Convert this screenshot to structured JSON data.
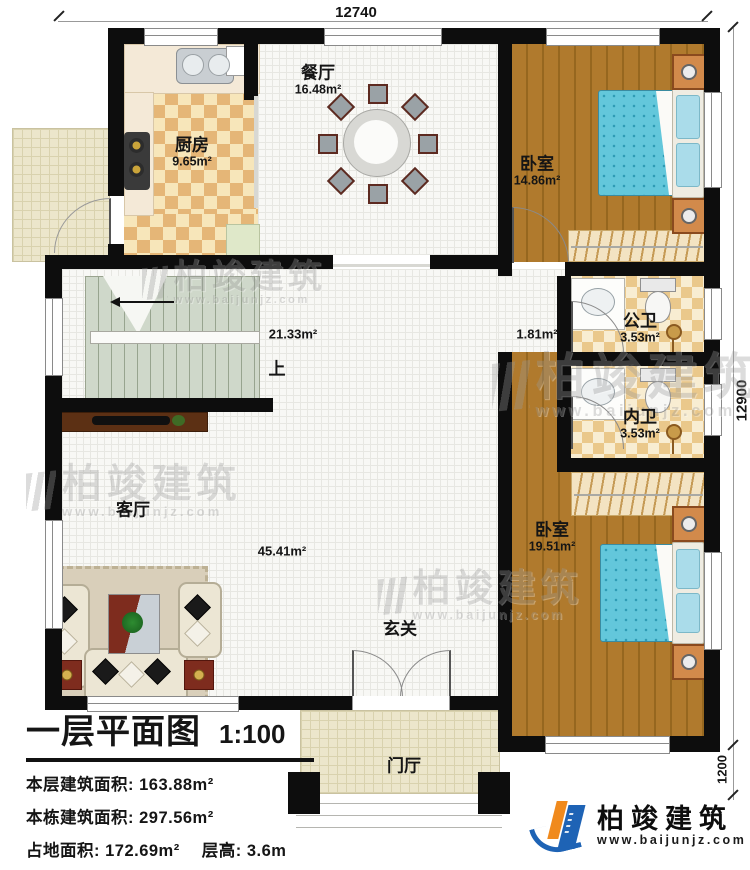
{
  "dimensions": {
    "top": "12740",
    "right": "12900",
    "porch": "1200"
  },
  "rooms": {
    "kitchen": {
      "name": "厨房",
      "area": "9.65m²"
    },
    "dining": {
      "name": "餐厅",
      "area": "16.48m²"
    },
    "bedroom_top": {
      "name": "卧室",
      "area": "14.86m²"
    },
    "public_bath": {
      "name": "公卫",
      "area": "3.53m²"
    },
    "inner_bath": {
      "name": "内卫",
      "area": "3.53m²"
    },
    "bedroom_bottom": {
      "name": "卧室",
      "area": "19.51m²"
    },
    "living": {
      "name": "客厅",
      "area": "45.41m²"
    },
    "hall": {
      "area": "21.33m²"
    },
    "corridor": {
      "area": "1.81m²"
    },
    "entry": {
      "name": "玄关"
    },
    "porch": {
      "name": "门厅"
    },
    "stairs_up": "上"
  },
  "titleblock": {
    "title": "一层平面图",
    "scale": "1:100",
    "line1_label": "本层建筑面积: ",
    "line1_value": "163.88m²",
    "line2_label": "本栋建筑面积: ",
    "line2_value": "297.56m²",
    "line3_label": "占地面积: ",
    "line3_value": "172.69m²",
    "line3b_label": "层高: ",
    "line3b_value": "3.6m"
  },
  "watermark": {
    "brand": "柏竣建筑",
    "url": "www.baijunjz.com"
  },
  "logo": {
    "brand": "柏竣建筑",
    "url": "www.baijunjz.com"
  }
}
